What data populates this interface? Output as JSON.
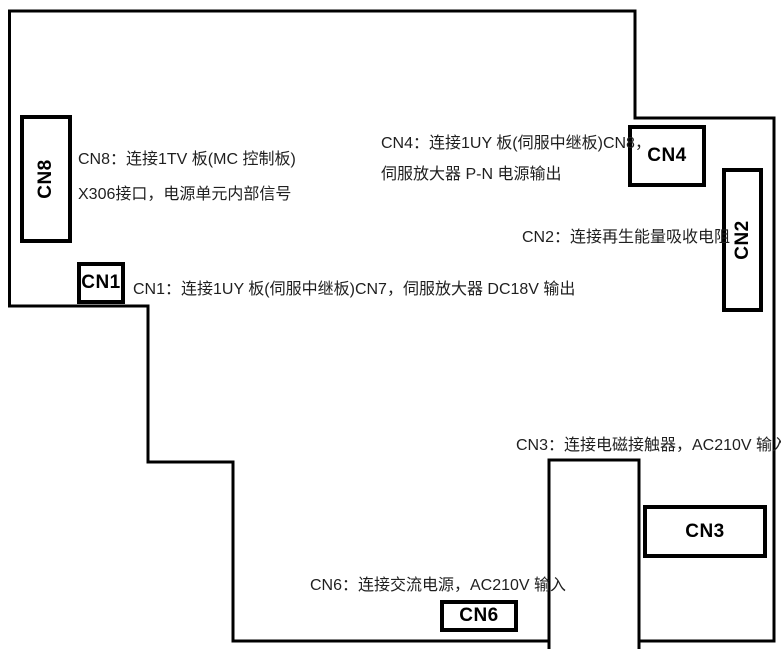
{
  "diagram": {
    "title": "power-unit-board-connector-diagram",
    "colors": {
      "outline": "#000000",
      "text": "#1f1f1f",
      "background": "#ffffff"
    }
  },
  "connectors": {
    "cn8": {
      "label": "CN8",
      "desc_line1": "CN8：连接1TV 板(MC 控制板)",
      "desc_line2": "X306接口，电源单元内部信号"
    },
    "cn4": {
      "label": "CN4",
      "desc_line1": "CN4：连接1UY 板(伺服中继板)CN8，",
      "desc_line2": "伺服放大器 P-N 电源输出"
    },
    "cn2": {
      "label": "CN2",
      "desc": "CN2：连接再生能量吸收电阻"
    },
    "cn1": {
      "label": "CN1",
      "desc": "CN1：连接1UY 板(伺服中继板)CN7，伺服放大器 DC18V 输出"
    },
    "cn3": {
      "label": "CN3",
      "desc": "CN3：连接电磁接触器，AC210V 输入"
    },
    "cn6": {
      "label": "CN6",
      "desc": "CN6：连接交流电源，AC210V 输入"
    }
  }
}
